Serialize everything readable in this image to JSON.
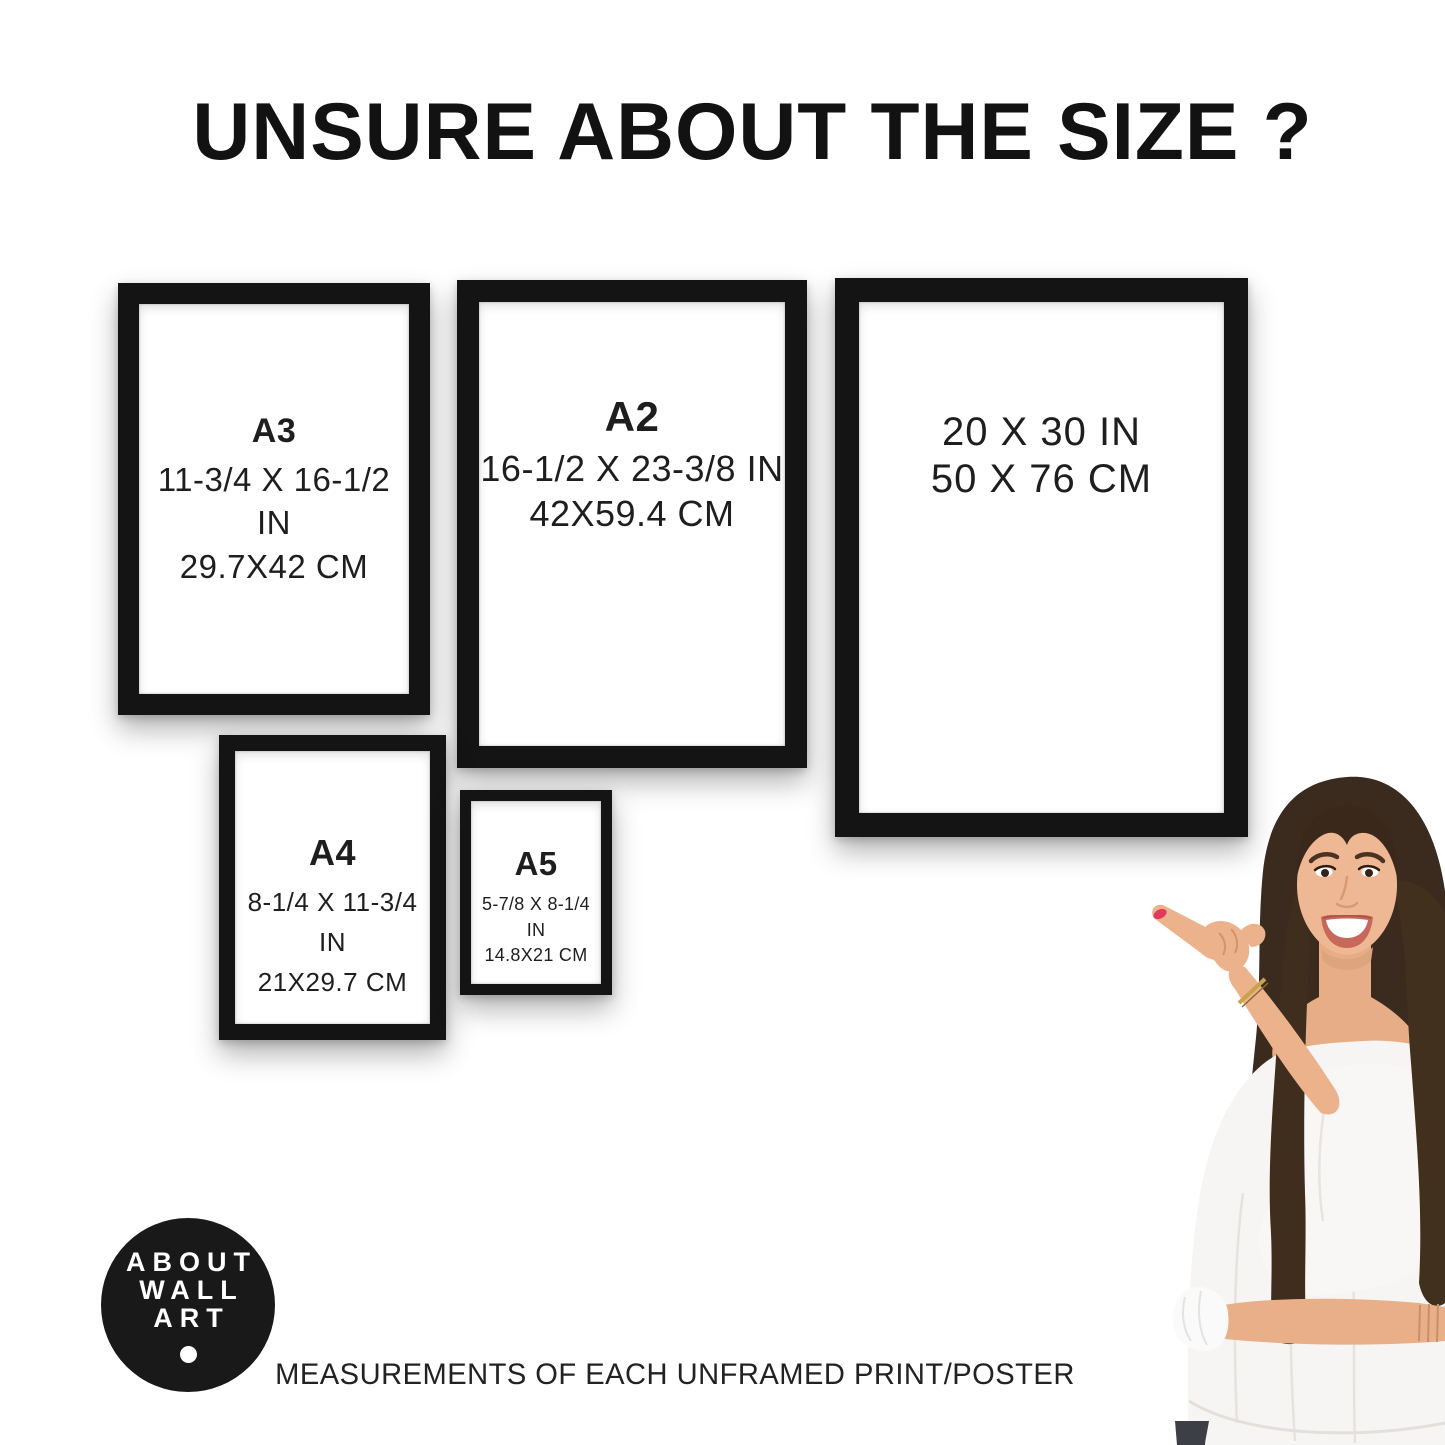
{
  "title": "UNSURE ABOUT THE SIZE ?",
  "frames": [
    {
      "label": "A3",
      "inches": "11-3/4 X 16-1/2 IN",
      "cm": "29.7X42 CM"
    },
    {
      "label": "A2",
      "inches": "16-1/2 X 23-3/8 IN",
      "cm": "42X59.4 CM"
    },
    {
      "label": "",
      "inches": "20 X 30 IN",
      "cm": "50 X 76 CM"
    },
    {
      "label": "A4",
      "inches": "8-1/4 X 11-3/4 IN",
      "cm": "21X29.7 CM"
    },
    {
      "label": "A5",
      "inches": "5-7/8 X 8-1/4 IN",
      "cm": "14.8X21 CM"
    }
  ],
  "logo": {
    "line1": "ABOUT",
    "line2": "WALL",
    "line3": "ART"
  },
  "footer": "MEASUREMENTS OF EACH UNFRAMED PRINT/POSTER",
  "colors": {
    "background": "#ffffff",
    "frame": "#141414",
    "text": "#1c1c1c",
    "logo_bg": "#191919",
    "logo_text": "#ffffff",
    "hair": "#3b2a1e",
    "skin": "#ecb28c",
    "blouse": "#f7f5f3",
    "nail": "#e23a5e",
    "bracelet": "#c9a24e",
    "jeans": "#3c3f45"
  }
}
